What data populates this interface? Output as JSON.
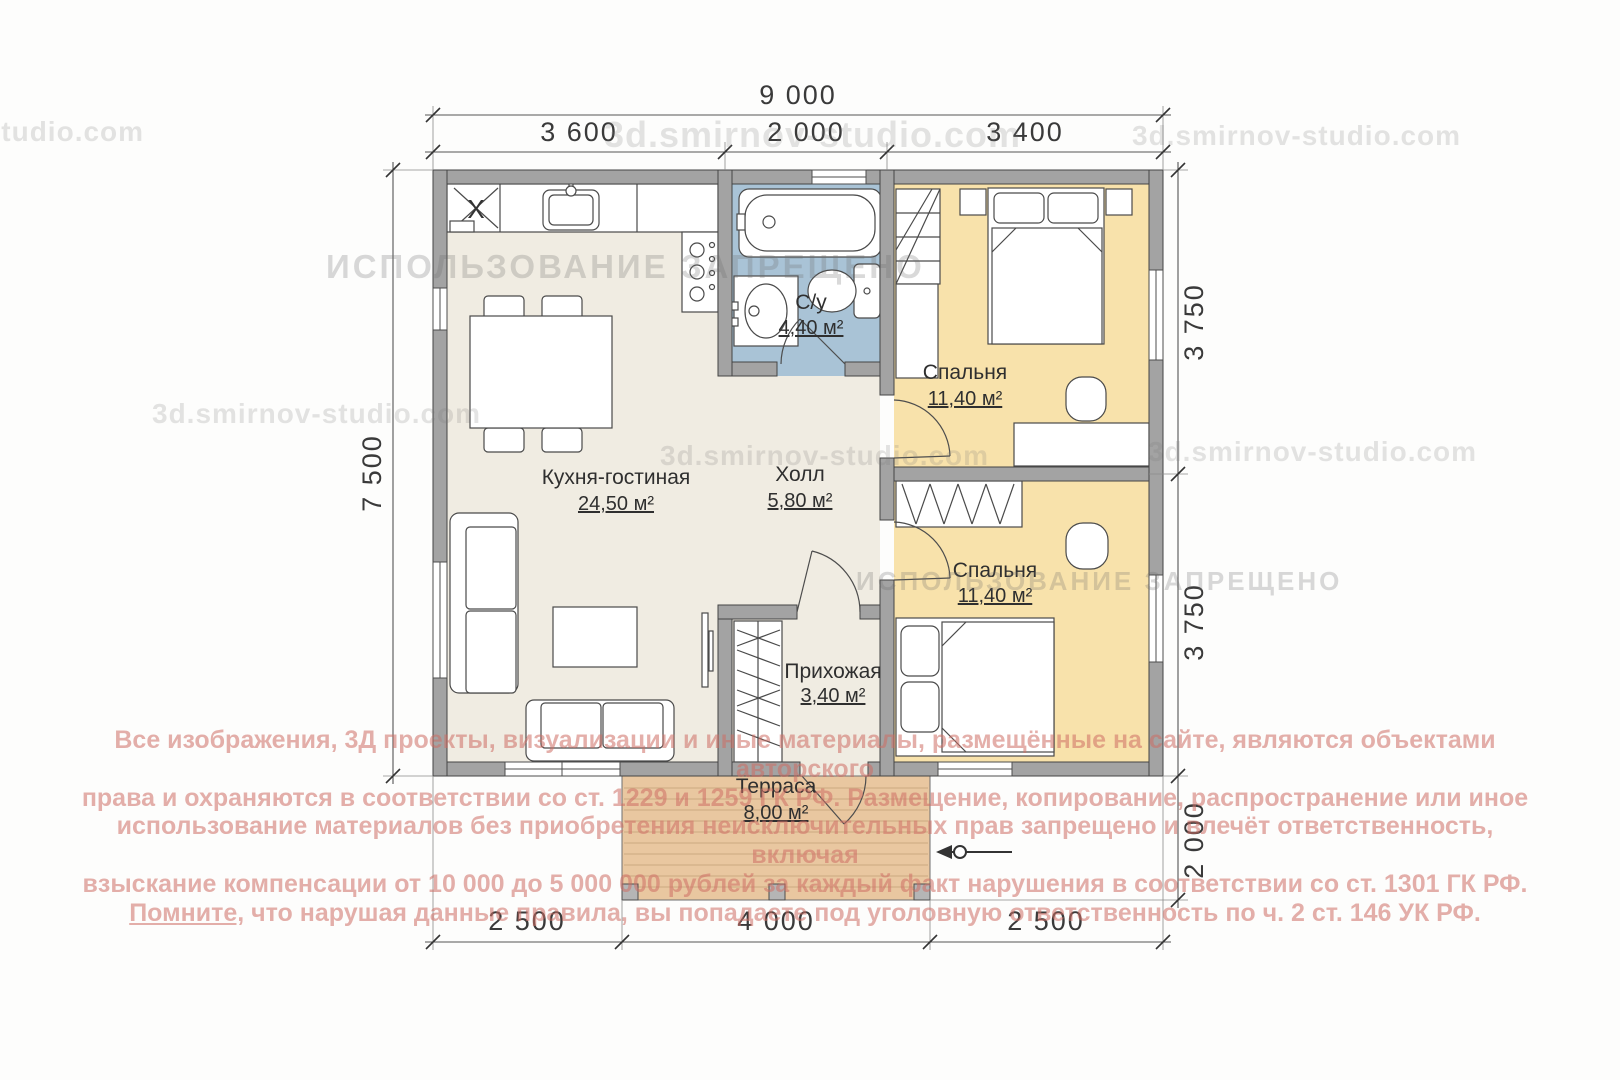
{
  "watermarks": {
    "site": "3d.smirnov-studio.com",
    "banner": "ИСПОЛЬЗОВАНИЕ ЗАПРЕЩЕНО",
    "copyright": {
      "line1": "Все изображения, 3Д проекты, визуализации и иные материалы, размещённые на сайте, являются объектами авторского",
      "line2": "права и охраняются в соответствии со ст. 1229 и 1259 ГК РФ. Размещение, копирование, распространение или иное",
      "line3": "использование материалов без приобретения неисключительных прав запрещено и влечёт ответственность, включая",
      "line4": "взыскание компенсации от 10 000 до 5 000 000 рублей за каждый факт нарушения в соответствии со ст. 1301 ГК РФ.",
      "line5_underlined": "Помните,",
      "line5_rest": " что нарушая данные правила, вы попадаете под уголовную ответственность по ч. 2 ст. 146 УК РФ."
    }
  },
  "dimensions": {
    "top_total": "9 000",
    "top_seg1": "3 600",
    "top_seg2": "2 000",
    "top_seg3": "3 400",
    "left_total": "7 500",
    "right_seg1": "3 750",
    "right_seg2": "3 750",
    "right_seg3": "2 000",
    "bottom_seg1": "2 500",
    "bottom_seg2": "4 000",
    "bottom_seg3": "2 500"
  },
  "rooms": {
    "kitchen_living": {
      "name": "Кухня-гостиная",
      "area": "24,50 м²"
    },
    "hall": {
      "name": "Холл",
      "area": "5,80 м²"
    },
    "bathroom": {
      "name": "С/у",
      "area": "4,40 м²"
    },
    "bedroom1": {
      "name": "Спальня",
      "area": "11,40 м²"
    },
    "bedroom2": {
      "name": "Спальня",
      "area": "11,40 м²"
    },
    "entry": {
      "name": "Прихожая",
      "area": "3,40 м²"
    },
    "terrace": {
      "name": "Терраса",
      "area": "8,00 м²"
    }
  },
  "plan": {
    "kitchen_marker": "X"
  },
  "colors": {
    "wall": "#a3a3a3",
    "floor_main": "#f0ece2",
    "floor_bath": "#a9c3d6",
    "floor_bedroom": "#f8e2ab",
    "floor_terrace": "#e9c7a0"
  }
}
